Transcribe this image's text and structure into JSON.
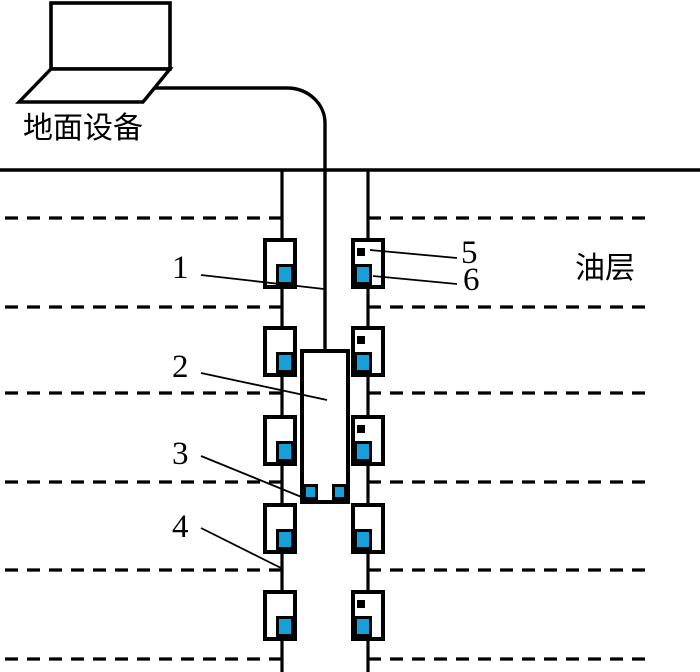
{
  "texts": {
    "surface_equipment": "地面设备",
    "oil_layer": "油层"
  },
  "colors": {
    "line": "#000000",
    "fill": "#ffffff",
    "sensor_blue": "#16A0D9"
  },
  "callouts": [
    {
      "label": "1",
      "leader": [
        201,
        275,
        324,
        289
      ]
    },
    {
      "label": "2",
      "leader": [
        201,
        373,
        327,
        400
      ]
    },
    {
      "label": "3",
      "leader": [
        201,
        456,
        304,
        498
      ]
    },
    {
      "label": "4",
      "leader": [
        201,
        528,
        281,
        568
      ]
    },
    {
      "label": "5",
      "leader": [
        370,
        250,
        457,
        258
      ]
    },
    {
      "label": "6",
      "leader": [
        373,
        276,
        457,
        284
      ]
    }
  ],
  "diagram": {
    "width": 700,
    "height": 672,
    "ground_y": 170,
    "laptop": {
      "screen": {
        "x": 51,
        "y": 3,
        "w": 119,
        "h": 66
      },
      "base_points": "51,69 170,69 143,102 19,102"
    },
    "cable_path": "M155 88 H287 A38 35 0 0 1 325 123 V351",
    "casing_x": [
      282,
      368
    ],
    "casing_bottom": 672,
    "dashed_lines": {
      "ys": [
        218,
        307,
        393,
        482,
        570,
        659
      ],
      "left_end": 282,
      "right_start": 368,
      "right_end": 649,
      "dash": "13 9"
    },
    "box_centers": {
      "left": 280,
      "right": 368
    },
    "box": {
      "w": 30,
      "h": 47,
      "stroke": 4
    },
    "sensor_boxes": [
      {
        "side": "left",
        "top": 240,
        "black_square": false
      },
      {
        "side": "left",
        "top": 328,
        "black_square": false
      },
      {
        "side": "left",
        "top": 417,
        "black_square": false
      },
      {
        "side": "left",
        "top": 505,
        "black_square": false
      },
      {
        "side": "left",
        "top": 592,
        "black_square": false
      },
      {
        "side": "right",
        "top": 240,
        "black_square": true
      },
      {
        "side": "right",
        "top": 328,
        "black_square": true
      },
      {
        "side": "right",
        "top": 417,
        "black_square": true
      },
      {
        "side": "right",
        "top": 505,
        "black_square": false
      },
      {
        "side": "right",
        "top": 592,
        "black_square": true
      }
    ],
    "tool": {
      "x": 302,
      "y": 351,
      "w": 46,
      "h": 151,
      "stroke": 4
    }
  }
}
